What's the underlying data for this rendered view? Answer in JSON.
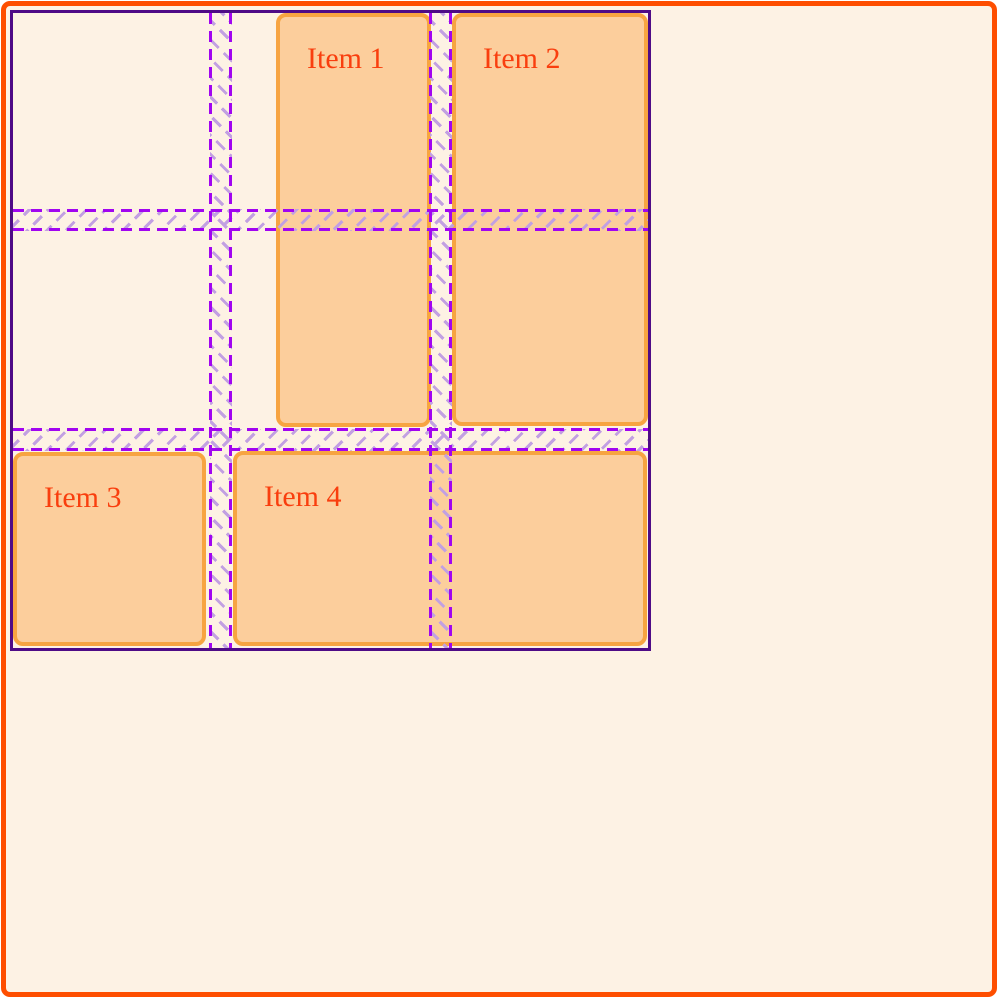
{
  "theme": {
    "page_bg": "#ffffff",
    "container_bg": "#fdf2e4",
    "container_border": "#fe4e00",
    "grid_border": "#4e0b86",
    "grid_line": "#a105f0",
    "grid_hatch": "#c2a0e2",
    "item_bg": "#fcce9c",
    "item_border": "#f7a441",
    "item_text": "#f93e0e"
  },
  "grid_overlay": {
    "columns": 3,
    "rows": 3,
    "gap_px": 22,
    "line_style": "dashed",
    "hatch_style": "diagonal-dashes"
  },
  "items": [
    {
      "label": "Item 1"
    },
    {
      "label": "Item 2"
    },
    {
      "label": "Item 3"
    },
    {
      "label": "Item 4"
    }
  ]
}
